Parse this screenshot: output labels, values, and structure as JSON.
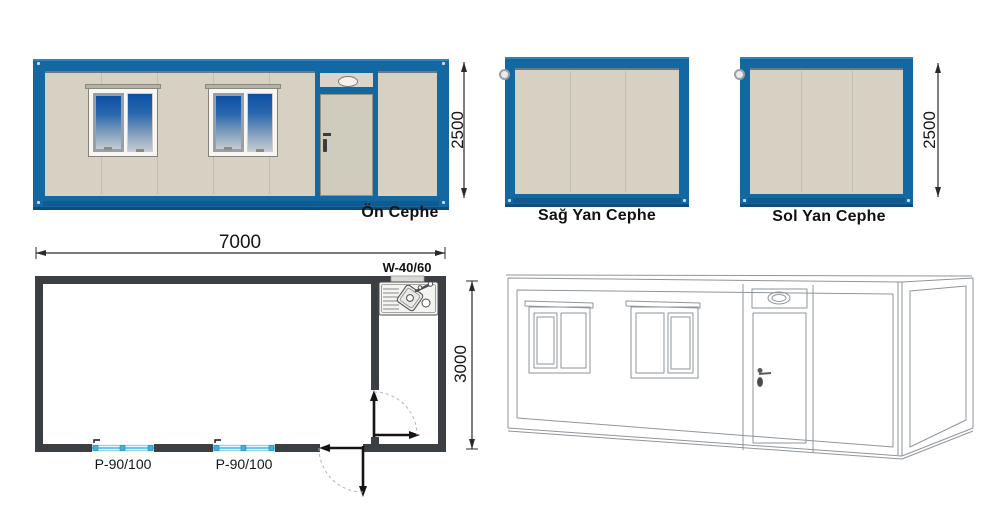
{
  "elevations": {
    "front": {
      "caption": "Ön Cephe",
      "height_dim": "2500"
    },
    "right": {
      "caption": "Sağ Yan Cephe"
    },
    "left": {
      "caption": "Sol Yan Cephe",
      "height_dim": "2500"
    }
  },
  "plan": {
    "width_dim": "7000",
    "depth_dim": "3000",
    "sink_window_label": "W-40/60",
    "window_labels": [
      "P-90/100",
      "P-90/100"
    ]
  },
  "colors": {
    "frame_blue": "#1468a2",
    "frame_blue_dark": "#0d4e7d",
    "wall_beige": "#d6d1c3",
    "plan_wall_gray": "#3b3e42",
    "glass_blue_top": "#0c4fa4",
    "glass_gray_bottom": "#c3ccd1",
    "plan_window_blue": "#49b6e0",
    "iso_line_gray": "#8f959b"
  },
  "icons": {
    "vent": "oval-vent",
    "hook": "lifting-hook",
    "sink": "double-bowl-sink",
    "door_swing": "door-swing-arrow"
  }
}
